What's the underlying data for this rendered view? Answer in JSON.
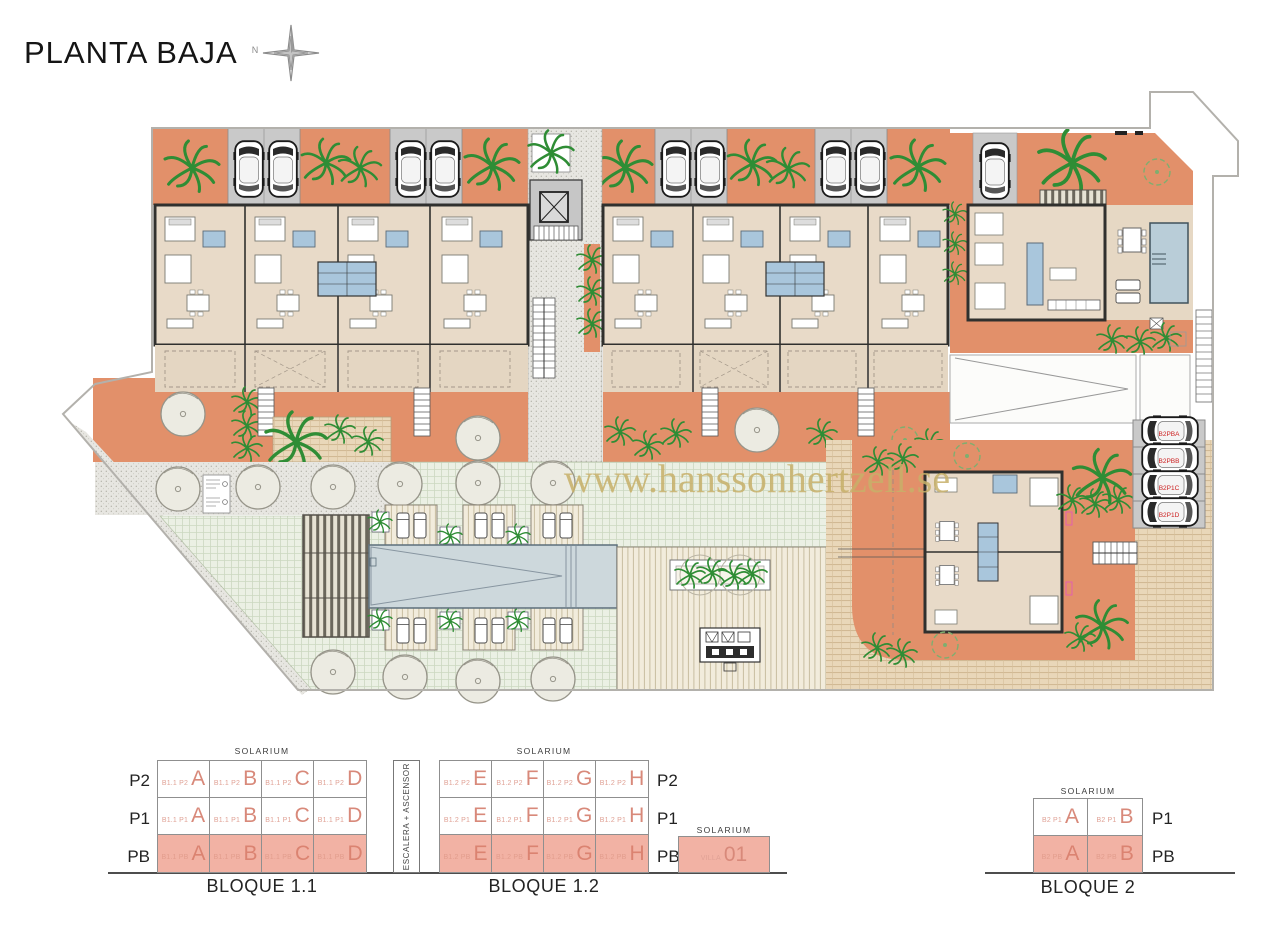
{
  "header": {
    "title": "PLANTA BAJA",
    "compass": "N"
  },
  "watermark": {
    "text": "www.hanssonhertzell.se"
  },
  "plan": {
    "b2_parking_labels": [
      "B2PBA",
      "B2PBB",
      "B2P1C",
      "B2P1D"
    ]
  },
  "schematics": {
    "stair_label": "ESCALERA + ASCENSOR",
    "solarium": "SOLARIUM",
    "blocks": [
      {
        "id": "bloque-1-1",
        "caption": "BLOQUE 1.1",
        "row_labels": [
          "P2",
          "P1",
          "PB"
        ],
        "rows": [
          {
            "level": "P2",
            "cells": [
              {
                "code": "B1.1 P2",
                "unit": "A"
              },
              {
                "code": "B1.1 P2",
                "unit": "B"
              },
              {
                "code": "B1.1 P2",
                "unit": "C"
              },
              {
                "code": "B1.1 P2",
                "unit": "D"
              }
            ]
          },
          {
            "level": "P1",
            "cells": [
              {
                "code": "B1.1 P1",
                "unit": "A"
              },
              {
                "code": "B1.1 P1",
                "unit": "B"
              },
              {
                "code": "B1.1 P1",
                "unit": "C"
              },
              {
                "code": "B1.1 P1",
                "unit": "D"
              }
            ]
          },
          {
            "level": "PB",
            "cells": [
              {
                "code": "B1.1 PB",
                "unit": "A"
              },
              {
                "code": "B1.1 PB",
                "unit": "B"
              },
              {
                "code": "B1.1 PB",
                "unit": "C"
              },
              {
                "code": "B1.1 PB",
                "unit": "D"
              }
            ]
          }
        ]
      },
      {
        "id": "bloque-1-2",
        "caption": "BLOQUE 1.2",
        "row_labels": [
          "P2",
          "P1",
          "PB"
        ],
        "rows": [
          {
            "level": "P2",
            "cells": [
              {
                "code": "B1.2 P2",
                "unit": "E"
              },
              {
                "code": "B1.2 P2",
                "unit": "F"
              },
              {
                "code": "B1.2 P2",
                "unit": "G"
              },
              {
                "code": "B1.2 P2",
                "unit": "H"
              }
            ]
          },
          {
            "level": "P1",
            "cells": [
              {
                "code": "B1.2 P1",
                "unit": "E"
              },
              {
                "code": "B1.2 P1",
                "unit": "F"
              },
              {
                "code": "B1.2 P1",
                "unit": "G"
              },
              {
                "code": "B1.2 P1",
                "unit": "H"
              }
            ]
          },
          {
            "level": "PB",
            "cells": [
              {
                "code": "B1.2 PB",
                "unit": "E"
              },
              {
                "code": "B1.2 PB",
                "unit": "F"
              },
              {
                "code": "B1.2 PB",
                "unit": "G"
              },
              {
                "code": "B1.2 PB",
                "unit": "H"
              }
            ]
          }
        ]
      },
      {
        "id": "villa",
        "caption": "",
        "cell": {
          "code": "VILLA",
          "unit": "01"
        }
      },
      {
        "id": "bloque-2",
        "caption": "BLOQUE 2",
        "row_labels": [
          "P1",
          "PB"
        ],
        "rows": [
          {
            "level": "P1",
            "cells": [
              {
                "code": "B2 P1",
                "unit": "A"
              },
              {
                "code": "B2 P1",
                "unit": "B"
              }
            ]
          },
          {
            "level": "PB",
            "cells": [
              {
                "code": "B2 PB",
                "unit": "A"
              },
              {
                "code": "B2 PB",
                "unit": "B"
              }
            ]
          }
        ]
      }
    ]
  },
  "colors": {
    "terracotta": "#e2906a",
    "building": "#e8dac8",
    "bath_blue": "#a9c6dc",
    "pool": "#cdd8dc",
    "highlight_salmon": "#f2b2a4",
    "unit_letter": "#d8897a",
    "watermark": "#c7b069",
    "parking_label_red": "#cc2020"
  },
  "icons": {
    "compass-rose-icon": "8-point star",
    "car-icon": "top-down car",
    "palm-tree-icon": "radiating fronds",
    "tree-icon": "outlined circle",
    "elevator-icon": "box with X",
    "stairs-icon": "hatched rungs",
    "sun-lounger-icon": "small rounded rect",
    "bbq-icon": "grill box"
  }
}
